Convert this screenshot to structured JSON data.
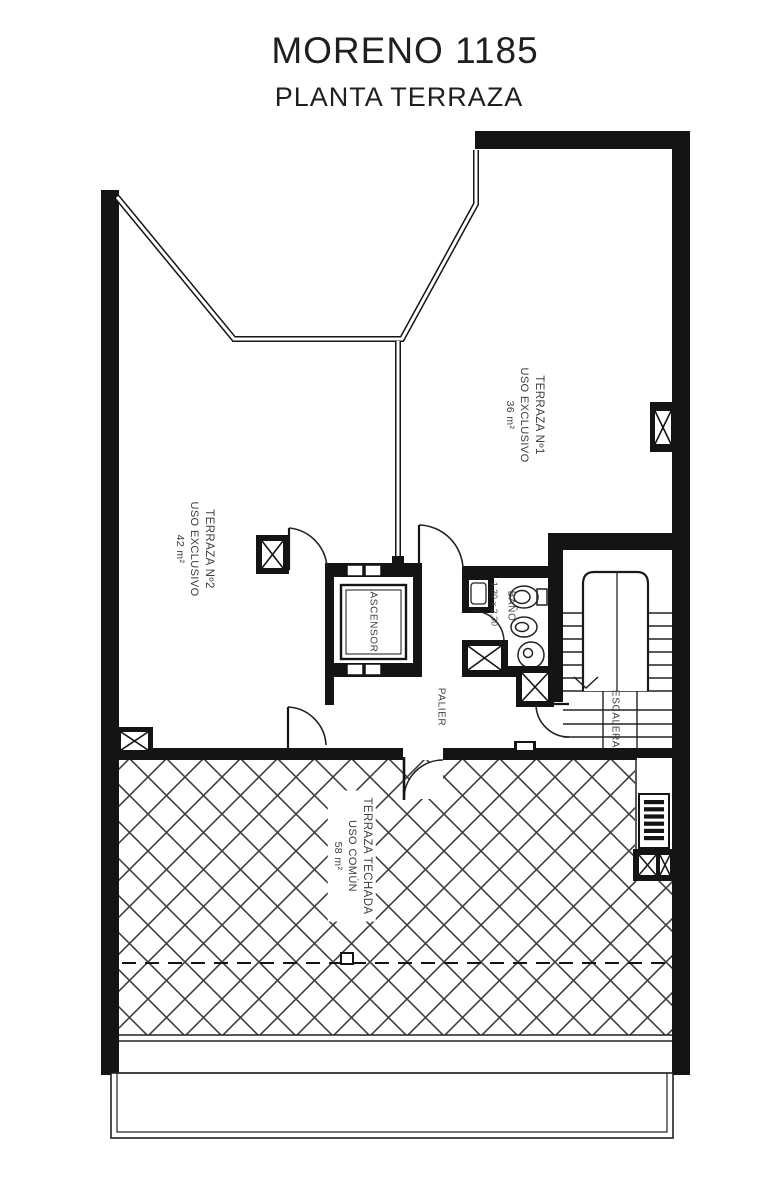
{
  "header": {
    "title": "MORENO 1185",
    "subtitle": "PLANTA TERRAZA"
  },
  "rooms": {
    "terraza1": {
      "lines": [
        "TERRAZA Nº1",
        "USO EXCLUSIVO",
        "36 m²"
      ]
    },
    "terraza2": {
      "lines": [
        "TERRAZA Nº2",
        "USO EXCLUSIVO",
        "42 m²"
      ]
    },
    "terraza_techada": {
      "lines": [
        "TERRAZA TECHADA",
        "USO COMÚN",
        "58 m²"
      ]
    },
    "ascensor": {
      "label": "ASCENSOR"
    },
    "bano": {
      "label": "BAÑO",
      "dimensions": "1,30 x 2,30"
    },
    "palier": {
      "label": "PALIER"
    },
    "escalera": {
      "label": "ESCALERA"
    }
  },
  "colors": {
    "wall": "#141414",
    "thin_line": "#222222",
    "hatch_line": "#3f3f3f",
    "label_text": "#3d3d3d",
    "background": "#ffffff"
  }
}
